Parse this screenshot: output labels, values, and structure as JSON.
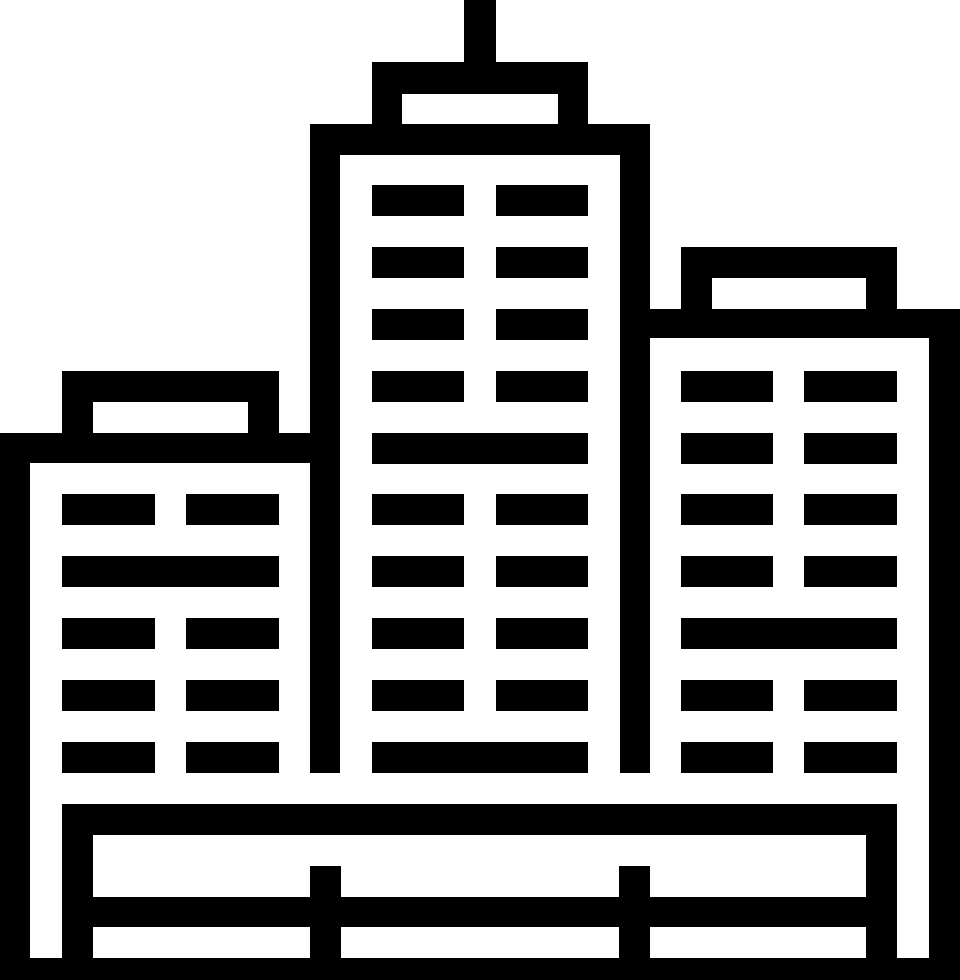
{
  "page": {
    "background_color": "#ffffff"
  },
  "icon": {
    "name": "city-buildings",
    "description": "Black pictograph icon of a city skyline: a tall center skyscraper with a rooftop antenna, a shorter building on the left, a mid-height building on the right, rows of dash-shaped windows, and a fenced base platform at the bottom.",
    "color": "#000000",
    "background_color": "#ffffff",
    "parts": {
      "left_building": "short building, 5 window rows, full-width band on row 2",
      "center_tower": "tall tower with antenna and roof cap, 10 window rows, full-width bands on rows 5 and 10",
      "right_building": "mid building, 7 window rows, full-width band on row 5",
      "base": "platform with fence rail, two posts and ground line"
    }
  }
}
